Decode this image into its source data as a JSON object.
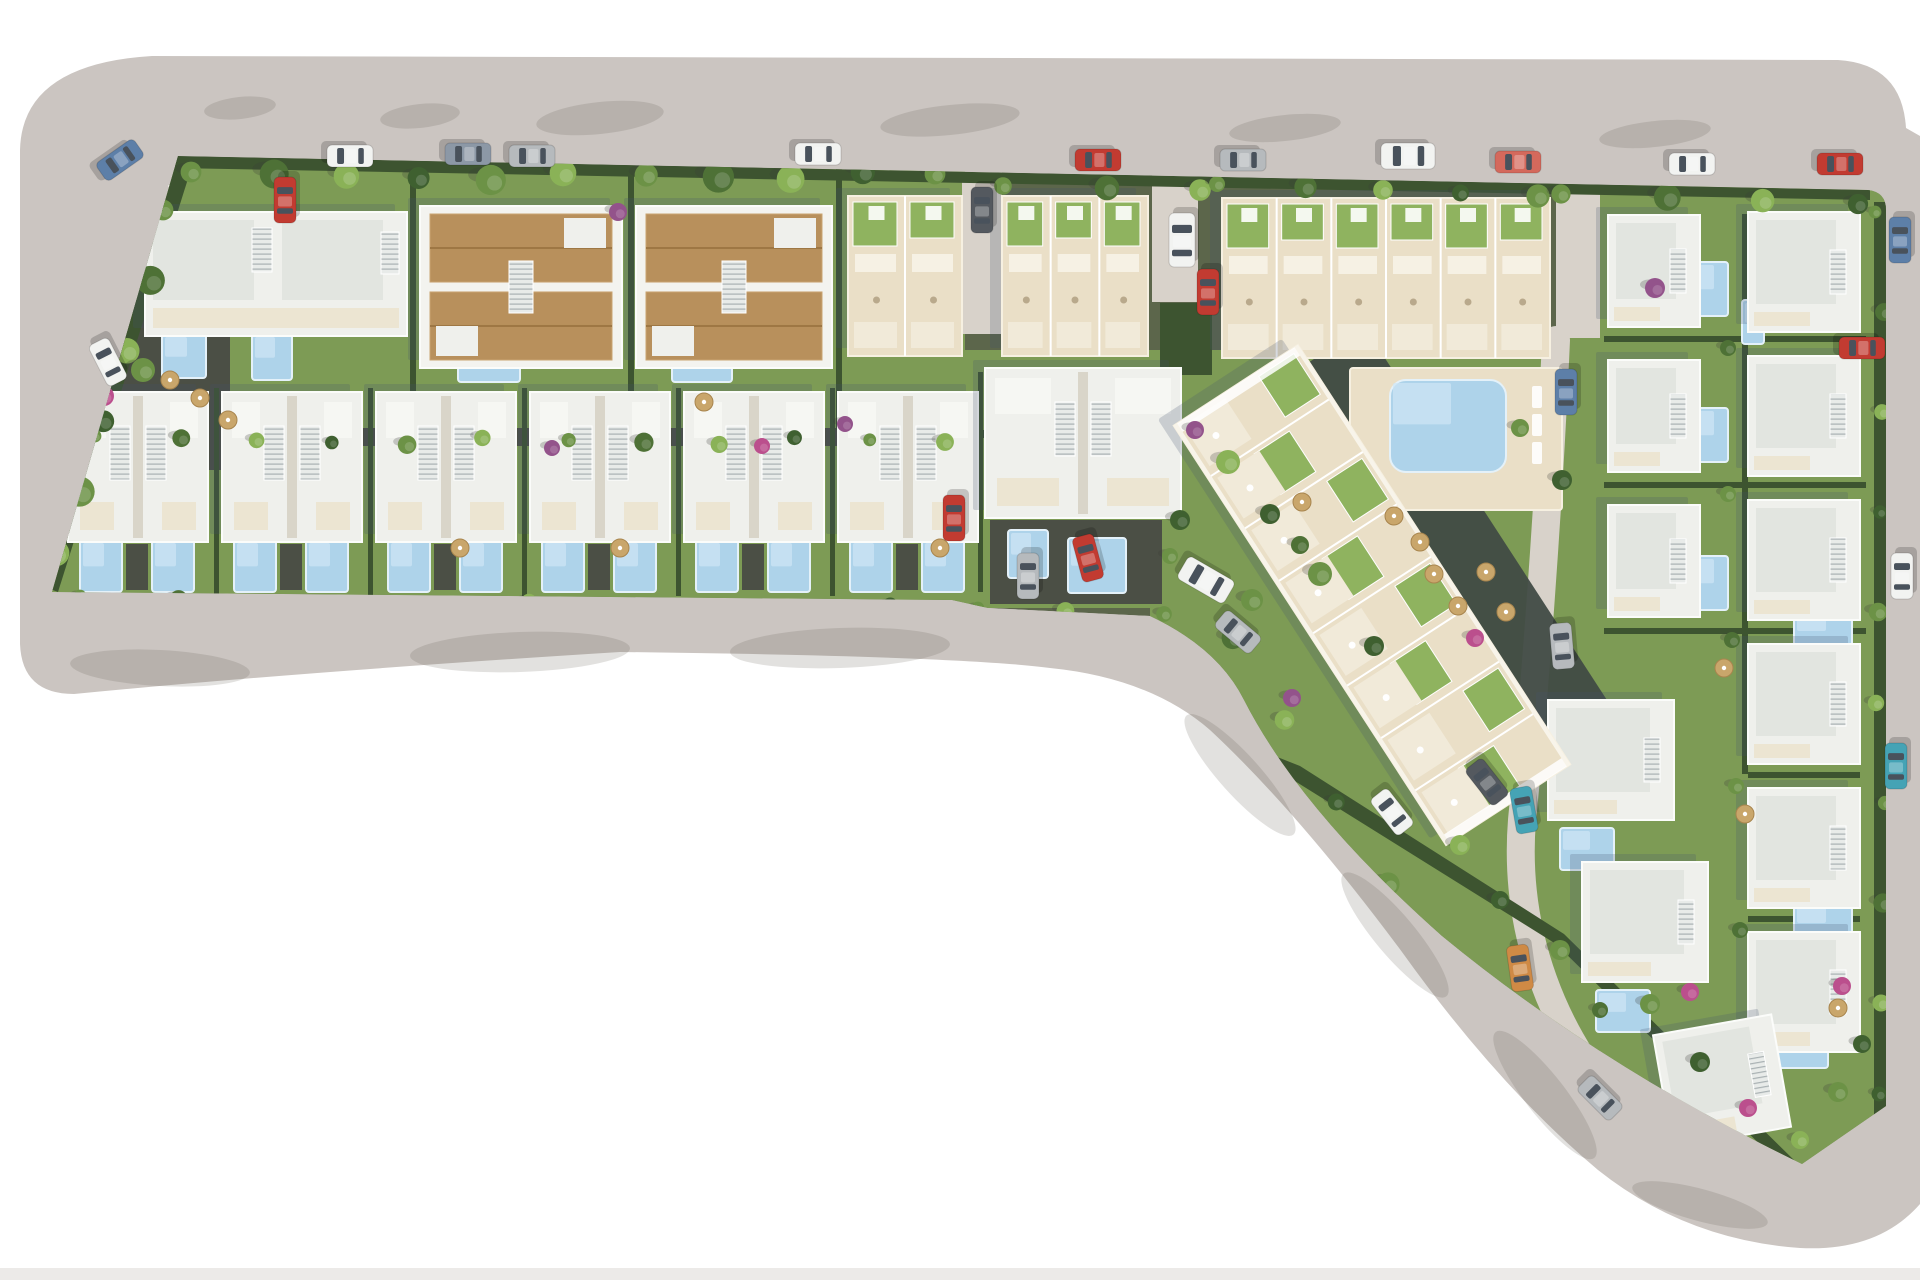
{
  "meta": {
    "label": "Aerial 3D site plan render of a residential development with villas, townhouses, apartment block and pools"
  },
  "canvas": {
    "w": 1920,
    "h": 1280
  },
  "palette": {
    "bg": "#ffffff",
    "road": "#cbc5c1",
    "roadShadow": "rgba(96,86,80,0.18)",
    "strip": "#eceae8",
    "soil": "#5c664b",
    "grass": "#7d9b55",
    "grassBright": "#8fb35f",
    "hedge": "#3d5430",
    "pathDark": "#4b4f45",
    "laneLight": "#d8d2ca",
    "deck": "#eadfc7",
    "deckEdge": "#f6f0e1",
    "roofWhite": "#eff0ec",
    "roofShade": "#e2e5e0",
    "roofEdge": "#fbfcfa",
    "tan": "#b8905c",
    "tanEdge": "#caa472",
    "tanDark": "#9e7744",
    "cream": "#ece5d2",
    "terraceLight": "#f1ead9",
    "pool": "#aed3ea",
    "poolEdge": "#e4f1f9",
    "rockery": "#414b44",
    "stairBg": "#e8ebe9",
    "stairLn": "#a9b1b3",
    "shadow": "rgba(70,82,110,0.22)",
    "umbrella": "#c9a66b",
    "trees": {
      "g1": "#4e7136",
      "g2": "#6c9246",
      "g3": "#8ab257",
      "palm": "#3f6030",
      "purple": "#93538b",
      "magenta": "#bb4f8d"
    },
    "cars": {
      "white": "#f2f3f1",
      "silver": "#b6babd",
      "steel": "#8c98a6",
      "blue": "#5d7fa8",
      "red": "#c23b31",
      "salmon": "#d4695c",
      "teal": "#45a3b5",
      "orange": "#cf8a45",
      "charcoal": "#54595f"
    }
  },
  "road": {
    "outline": "M 152 56 L 1838 60 Q 1902 64 1906 128 L 1920 136 L 1920 1204 Q 1878 1252 1800 1248 Q 1686 1240 1598 1170 Q 1498 1086 1402 952 Q 1298 812 1210 730 Q 1150 678 1050 668 Q 960 656 620 652 Q 300 672 74 694 Q 22 694 20 644 L 20 150 Q 22 64 152 56 Z",
    "marking": "M168 186 L940 186 L1200 192 L1556 202 L1868 212",
    "bottom_strip": {
      "x": 0,
      "y": 1268,
      "w": 1920,
      "h": 12
    },
    "shadows": [
      [
        240,
        108,
        36,
        11,
        -6
      ],
      [
        420,
        116,
        40,
        12,
        -6
      ],
      [
        600,
        118,
        64,
        16,
        -6
      ],
      [
        950,
        120,
        70,
        15,
        -6
      ],
      [
        1285,
        128,
        56,
        13,
        -6
      ],
      [
        1655,
        134,
        56,
        13,
        -6
      ],
      [
        160,
        668,
        90,
        18,
        3
      ],
      [
        520,
        652,
        110,
        20,
        -2
      ],
      [
        840,
        648,
        110,
        20,
        -2
      ],
      [
        1240,
        775,
        80,
        20,
        48
      ],
      [
        1395,
        935,
        80,
        20,
        50
      ],
      [
        1545,
        1095,
        80,
        20,
        52
      ],
      [
        1700,
        1205,
        70,
        16,
        15
      ]
    ]
  },
  "parcel": {
    "outline": "M 178 156 L 1868 190 Q 1886 192 1886 210 L 1886 1106 L 1802 1164 Q 1600 1066 1442 936 Q 1300 810 1244 700 Q 1218 648 1150 616 L 988 608 L 952 600 L 52 592 Z"
  },
  "zones": [
    {
      "x": 95,
      "y": 168,
      "w": 870,
      "h": 268
    },
    {
      "x": 848,
      "y": 350,
      "w": 704,
      "h": 88
    },
    {
      "x": 1556,
      "y": 185,
      "w": 330,
      "h": 990
    },
    {
      "x": 1150,
      "y": 420,
      "w": 450,
      "h": 760
    },
    {
      "x": 48,
      "y": 382,
      "w": 1140,
      "h": 226
    }
  ],
  "dark_paths": [
    {
      "x": 60,
      "y": 428,
      "w": 920,
      "h": 18
    },
    {
      "x": 126,
      "y": 544,
      "w": 22,
      "h": 46
    },
    {
      "x": 280,
      "y": 544,
      "w": 22,
      "h": 46
    },
    {
      "x": 434,
      "y": 544,
      "w": 22,
      "h": 46
    },
    {
      "x": 588,
      "y": 544,
      "w": 22,
      "h": 46
    },
    {
      "x": 742,
      "y": 544,
      "w": 22,
      "h": 46
    },
    {
      "x": 896,
      "y": 544,
      "w": 22,
      "h": 46
    },
    {
      "x": 990,
      "y": 520,
      "w": 172,
      "h": 84
    },
    {
      "x": 110,
      "y": 300,
      "w": 120,
      "h": 170
    }
  ],
  "lanes": [
    {
      "x": 962,
      "y": 172,
      "w": 40,
      "h": 162
    },
    {
      "x": 1152,
      "y": 172,
      "w": 46,
      "h": 130
    },
    {
      "x": 1556,
      "y": 190,
      "w": 44,
      "h": 148
    }
  ],
  "lane_path": "M1556 340 C 1548 520 1534 700 1522 820 C 1514 920 1544 1040 1650 1140",
  "hedges": {
    "paths": [
      "M175 156 L1870 190 L1870 200 L175 168 Z",
      "M178 156 L42 586 L58 592 L192 166 Z",
      "M52 598 L950 604 L988 648 L978 656 L48 612 Z",
      "M1006 650 L1300 766 L1564 934 L1798 1164 L1788 1172 L1556 944 L1290 778 L1000 662 Z"
    ],
    "rects": [
      [
        1874,
        202,
        12,
        915
      ],
      [
        410,
        168,
        6,
        262
      ],
      [
        628,
        168,
        6,
        262
      ],
      [
        836,
        168,
        6,
        262
      ],
      [
        214,
        388,
        5,
        208
      ],
      [
        368,
        388,
        5,
        208
      ],
      [
        522,
        388,
        5,
        208
      ],
      [
        676,
        388,
        5,
        208
      ],
      [
        830,
        388,
        5,
        208
      ],
      [
        978,
        372,
        5,
        220
      ],
      [
        1604,
        336,
        262,
        6
      ],
      [
        1604,
        482,
        262,
        6
      ],
      [
        1604,
        628,
        262,
        6
      ],
      [
        1748,
        772,
        112,
        6
      ],
      [
        1748,
        916,
        112,
        6
      ],
      [
        1742,
        214,
        6,
        560
      ],
      [
        965,
        430,
        585,
        8
      ],
      [
        1160,
        303,
        52,
        72
      ]
    ]
  },
  "rockery": {
    "cx": 1456,
    "cy": 541,
    "len": 460,
    "wid": 80,
    "rot": 57
  },
  "decks": [
    {
      "x": 1350,
      "y": 368,
      "w": 212,
      "h": 142
    }
  ],
  "loungers": [
    [
      1532,
      386,
      10,
      22
    ],
    [
      1532,
      414,
      10,
      22
    ],
    [
      1532,
      442,
      10,
      22
    ]
  ],
  "pools": [
    {
      "x": 162,
      "y": 334,
      "w": 44,
      "h": 44
    },
    {
      "x": 252,
      "y": 334,
      "w": 40,
      "h": 46
    },
    {
      "x": 458,
      "y": 334,
      "w": 62,
      "h": 48
    },
    {
      "x": 672,
      "y": 334,
      "w": 60,
      "h": 48
    },
    {
      "x": 80,
      "y": 540,
      "w": 42,
      "h": 52
    },
    {
      "x": 152,
      "y": 540,
      "w": 42,
      "h": 52
    },
    {
      "x": 234,
      "y": 540,
      "w": 42,
      "h": 52
    },
    {
      "x": 306,
      "y": 540,
      "w": 42,
      "h": 52
    },
    {
      "x": 388,
      "y": 540,
      "w": 42,
      "h": 52
    },
    {
      "x": 460,
      "y": 540,
      "w": 42,
      "h": 52
    },
    {
      "x": 542,
      "y": 540,
      "w": 42,
      "h": 52
    },
    {
      "x": 614,
      "y": 540,
      "w": 42,
      "h": 52
    },
    {
      "x": 696,
      "y": 540,
      "w": 42,
      "h": 52
    },
    {
      "x": 768,
      "y": 540,
      "w": 42,
      "h": 52
    },
    {
      "x": 850,
      "y": 540,
      "w": 42,
      "h": 52
    },
    {
      "x": 922,
      "y": 540,
      "w": 42,
      "h": 52
    },
    {
      "x": 1008,
      "y": 530,
      "w": 40,
      "h": 48
    },
    {
      "x": 1068,
      "y": 538,
      "w": 58,
      "h": 55
    },
    {
      "x": 1694,
      "y": 262,
      "w": 34,
      "h": 54
    },
    {
      "x": 1694,
      "y": 408,
      "w": 34,
      "h": 54
    },
    {
      "x": 1694,
      "y": 556,
      "w": 34,
      "h": 54
    },
    {
      "x": 1742,
      "y": 300,
      "w": 22,
      "h": 44
    },
    {
      "x": 1794,
      "y": 610,
      "w": 58,
      "h": 40
    },
    {
      "x": 1794,
      "y": 902,
      "w": 58,
      "h": 40
    },
    {
      "x": 1560,
      "y": 828,
      "w": 54,
      "h": 42
    },
    {
      "x": 1596,
      "y": 990,
      "w": 54,
      "h": 42
    },
    {
      "x": 1766,
      "y": 1032,
      "w": 62,
      "h": 36
    },
    {
      "x": 1390,
      "y": 380,
      "w": 116,
      "h": 92,
      "rx": 16,
      "communal": true
    }
  ],
  "buildings": [
    {
      "t": "villaW",
      "x": 145,
      "y": 212,
      "w": 262,
      "h": 124
    },
    {
      "t": "villaT",
      "x": 420,
      "y": 206,
      "w": 202,
      "h": 162
    },
    {
      "t": "villaT",
      "x": 636,
      "y": 206,
      "w": 196,
      "h": 162
    },
    {
      "t": "terrace",
      "x": 848,
      "y": 196,
      "w": 114,
      "h": 160,
      "u": 2
    },
    {
      "t": "terrace",
      "x": 1002,
      "y": 196,
      "w": 146,
      "h": 160,
      "u": 3
    },
    {
      "t": "terrace",
      "x": 1222,
      "y": 198,
      "w": 328,
      "h": 160,
      "u": 6
    },
    {
      "t": "villa2",
      "x": 68,
      "y": 392,
      "w": 140,
      "h": 150
    },
    {
      "t": "villa2",
      "x": 222,
      "y": 392,
      "w": 140,
      "h": 150
    },
    {
      "t": "villa2",
      "x": 376,
      "y": 392,
      "w": 140,
      "h": 150
    },
    {
      "t": "villa2",
      "x": 530,
      "y": 392,
      "w": 140,
      "h": 150
    },
    {
      "t": "villa2",
      "x": 684,
      "y": 392,
      "w": 140,
      "h": 150
    },
    {
      "t": "villa2",
      "x": 838,
      "y": 392,
      "w": 140,
      "h": 150
    },
    {
      "t": "villa2",
      "x": 985,
      "y": 368,
      "w": 196,
      "h": 150
    },
    {
      "t": "villaS",
      "x": 1608,
      "y": 215,
      "w": 92,
      "h": 112
    },
    {
      "t": "villaS",
      "x": 1608,
      "y": 360,
      "w": 92,
      "h": 112
    },
    {
      "t": "villaS",
      "x": 1608,
      "y": 505,
      "w": 92,
      "h": 112
    },
    {
      "t": "villaS",
      "x": 1748,
      "y": 212,
      "w": 112,
      "h": 120
    },
    {
      "t": "villaS",
      "x": 1748,
      "y": 356,
      "w": 112,
      "h": 120
    },
    {
      "t": "villaS",
      "x": 1748,
      "y": 500,
      "w": 112,
      "h": 120
    },
    {
      "t": "villaS",
      "x": 1748,
      "y": 644,
      "w": 112,
      "h": 120
    },
    {
      "t": "villaS",
      "x": 1748,
      "y": 788,
      "w": 112,
      "h": 120
    },
    {
      "t": "villaS",
      "x": 1748,
      "y": 932,
      "w": 112,
      "h": 120
    },
    {
      "t": "villaS",
      "x": 1548,
      "y": 700,
      "w": 126,
      "h": 120
    },
    {
      "t": "villaS",
      "x": 1582,
      "y": 862,
      "w": 126,
      "h": 120
    },
    {
      "t": "villaS",
      "x": 1662,
      "y": 1024,
      "w": 120,
      "h": 114,
      "rot": -10
    }
  ],
  "apartment": {
    "cx": 1372,
    "cy": 595,
    "len": 500,
    "wid": 148,
    "rot": 57,
    "units": 8
  },
  "tree_rows": [
    [
      196,
      176,
      938,
      176,
      11,
      13
    ],
    [
      1008,
      190,
      1198,
      190,
      3,
      11
    ],
    [
      1222,
      188,
      1540,
      192,
      5,
      10
    ],
    [
      1566,
      198,
      1858,
      202,
      4,
      12
    ],
    [
      168,
      214,
      60,
      556,
      6,
      13
    ],
    [
      100,
      440,
      950,
      442,
      12,
      8
    ],
    [
      85,
      600,
      1160,
      612,
      13,
      8
    ],
    [
      1175,
      560,
      1390,
      880,
      5,
      10
    ],
    [
      1880,
      216,
      1880,
      1098,
      10,
      8
    ]
  ],
  "trees": [
    [
      118,
      292,
      11,
      "purple"
    ],
    [
      104,
      396,
      10,
      "magenta"
    ],
    [
      143,
      370,
      12,
      "g2"
    ],
    [
      618,
      212,
      9,
      "purple"
    ],
    [
      845,
      424,
      8,
      "purple"
    ],
    [
      552,
      448,
      8,
      "purple"
    ],
    [
      762,
      446,
      8,
      "magenta"
    ],
    [
      1195,
      430,
      9,
      "purple"
    ],
    [
      1655,
      288,
      10,
      "purple"
    ],
    [
      1228,
      462,
      12,
      "g3"
    ],
    [
      1270,
      514,
      10,
      "palm"
    ],
    [
      1320,
      574,
      12,
      "g2"
    ],
    [
      1374,
      646,
      10,
      "palm"
    ],
    [
      1300,
      545,
      9,
      "g1"
    ],
    [
      1475,
      638,
      9,
      "magenta"
    ],
    [
      1562,
      480,
      10,
      "palm"
    ],
    [
      1520,
      428,
      9,
      "g2"
    ],
    [
      1180,
      520,
      10,
      "palm"
    ],
    [
      1252,
      600,
      11,
      "g2"
    ],
    [
      1292,
      698,
      9,
      "purple"
    ],
    [
      1460,
      845,
      10,
      "g3"
    ],
    [
      1500,
      900,
      9,
      "palm"
    ],
    [
      1560,
      950,
      10,
      "g2"
    ],
    [
      1650,
      1004,
      10,
      "g2"
    ],
    [
      1700,
      1062,
      10,
      "palm"
    ],
    [
      1748,
      1108,
      9,
      "magenta"
    ],
    [
      1800,
      1140,
      9,
      "g3"
    ],
    [
      1838,
      1092,
      10,
      "g2"
    ],
    [
      1862,
      1044,
      9,
      "palm"
    ],
    [
      1728,
      348,
      8,
      "g1"
    ],
    [
      1728,
      494,
      8,
      "g2"
    ],
    [
      1732,
      640,
      8,
      "g1"
    ],
    [
      1736,
      786,
      8,
      "g2"
    ],
    [
      1740,
      930,
      8,
      "g1"
    ],
    [
      1600,
      1010,
      8,
      "g1"
    ],
    [
      1690,
      992,
      9,
      "magenta"
    ],
    [
      1842,
      986,
      9,
      "magenta"
    ]
  ],
  "umbrellas": [
    [
      1394,
      516
    ],
    [
      1420,
      542
    ],
    [
      1434,
      574
    ],
    [
      1458,
      606
    ],
    [
      1486,
      572
    ],
    [
      1506,
      612
    ],
    [
      1302,
      502
    ],
    [
      170,
      380
    ],
    [
      200,
      398
    ],
    [
      228,
      420
    ],
    [
      704,
      402
    ],
    [
      460,
      548
    ],
    [
      620,
      548
    ],
    [
      940,
      548
    ],
    [
      1724,
      668
    ],
    [
      1745,
      814
    ],
    [
      1838,
      1008
    ]
  ],
  "cars": [
    {
      "x": 120,
      "y": 160,
      "rot": -35,
      "c": "blue"
    },
    {
      "x": 350,
      "y": 156,
      "rot": 0,
      "c": "white"
    },
    {
      "x": 468,
      "y": 154,
      "rot": 0,
      "c": "steel"
    },
    {
      "x": 532,
      "y": 156,
      "rot": 0,
      "c": "silver"
    },
    {
      "x": 818,
      "y": 154,
      "rot": 0,
      "c": "white"
    },
    {
      "x": 1098,
      "y": 160,
      "rot": 0,
      "c": "red"
    },
    {
      "x": 1243,
      "y": 160,
      "rot": 0,
      "c": "silver"
    },
    {
      "x": 1408,
      "y": 156,
      "rot": 0,
      "c": "white",
      "van": true
    },
    {
      "x": 1518,
      "y": 162,
      "rot": 0,
      "c": "salmon"
    },
    {
      "x": 1692,
      "y": 164,
      "rot": 0,
      "c": "white"
    },
    {
      "x": 1840,
      "y": 164,
      "rot": 0,
      "c": "red"
    },
    {
      "x": 1900,
      "y": 240,
      "rot": 90,
      "c": "blue"
    },
    {
      "x": 1902,
      "y": 576,
      "rot": 90,
      "c": "white"
    },
    {
      "x": 1896,
      "y": 766,
      "rot": 90,
      "c": "teal"
    },
    {
      "x": 1206,
      "y": 580,
      "rot": 30,
      "c": "white",
      "van": true
    },
    {
      "x": 1238,
      "y": 632,
      "rot": 40,
      "c": "silver"
    },
    {
      "x": 1392,
      "y": 812,
      "rot": 52,
      "c": "white"
    },
    {
      "x": 1487,
      "y": 782,
      "rot": 52,
      "c": "charcoal"
    },
    {
      "x": 285,
      "y": 200,
      "rot": 90,
      "c": "red"
    },
    {
      "x": 108,
      "y": 362,
      "rot": 63,
      "c": "white"
    },
    {
      "x": 982,
      "y": 210,
      "rot": 90,
      "c": "charcoal"
    },
    {
      "x": 1182,
      "y": 240,
      "rot": 90,
      "c": "white",
      "van": true
    },
    {
      "x": 1208,
      "y": 292,
      "rot": 90,
      "c": "red"
    },
    {
      "x": 1566,
      "y": 392,
      "rot": 90,
      "c": "blue"
    },
    {
      "x": 954,
      "y": 518,
      "rot": 90,
      "c": "red"
    },
    {
      "x": 1028,
      "y": 576,
      "rot": 90,
      "c": "silver"
    },
    {
      "x": 1088,
      "y": 558,
      "rot": 75,
      "c": "red"
    },
    {
      "x": 1562,
      "y": 646,
      "rot": 85,
      "c": "silver"
    },
    {
      "x": 1524,
      "y": 810,
      "rot": 80,
      "c": "teal"
    },
    {
      "x": 1520,
      "y": 968,
      "rot": 82,
      "c": "orange"
    },
    {
      "x": 1600,
      "y": 1098,
      "rot": 45,
      "c": "silver"
    },
    {
      "x": 1862,
      "y": 348,
      "rot": 0,
      "c": "red"
    }
  ]
}
